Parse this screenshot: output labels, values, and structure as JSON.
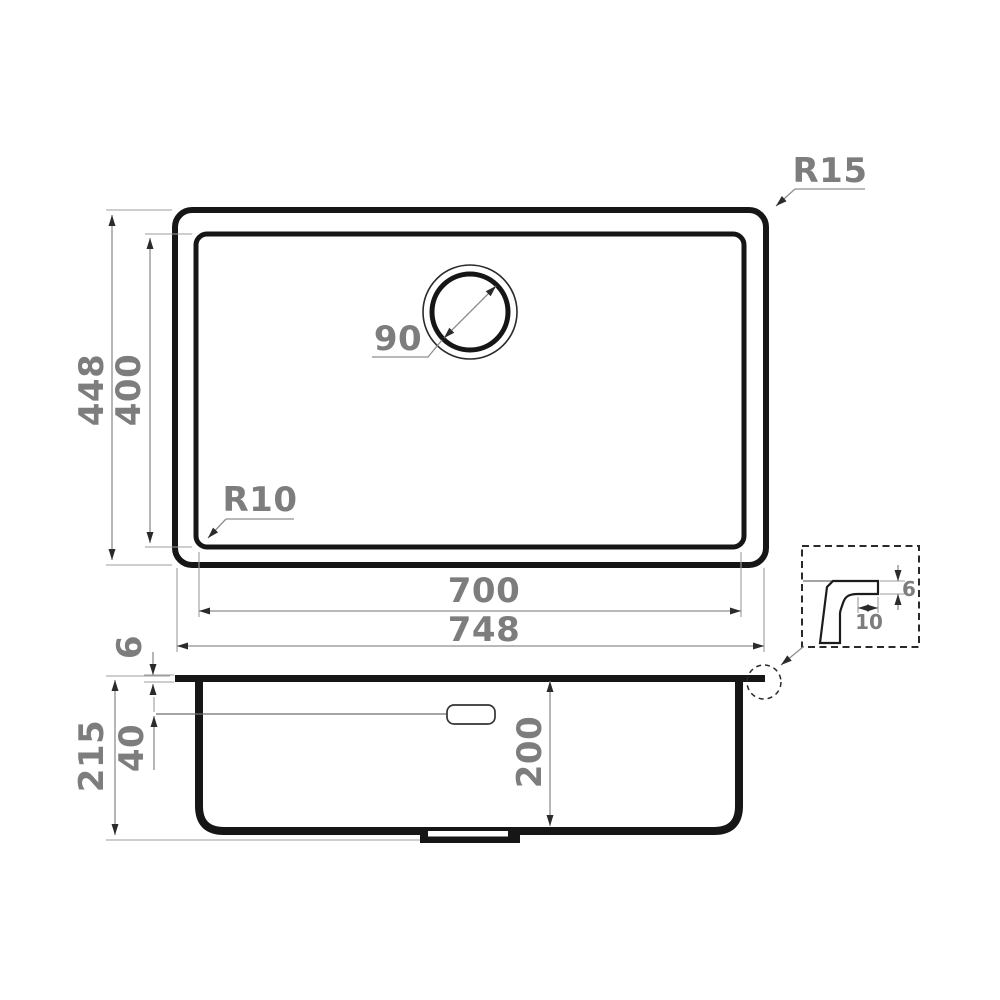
{
  "drawing": {
    "top_view": {
      "outer_width": "748",
      "inner_width": "700",
      "outer_height": "448",
      "inner_height": "400",
      "drain_diameter": "90",
      "outer_corner_radius": "R15",
      "inner_corner_radius": "R10"
    },
    "side_view": {
      "total_depth": "215",
      "rim_height": "6",
      "overflow_offset": "40",
      "bowl_depth": "200"
    },
    "detail_view": {
      "rim_thickness": "6",
      "rim_lip_width": "10"
    },
    "colors": {
      "outline": "#161616",
      "dimension_line": "#8f8f8f",
      "label_text": "#7d7d7d",
      "background": "#ffffff"
    }
  }
}
